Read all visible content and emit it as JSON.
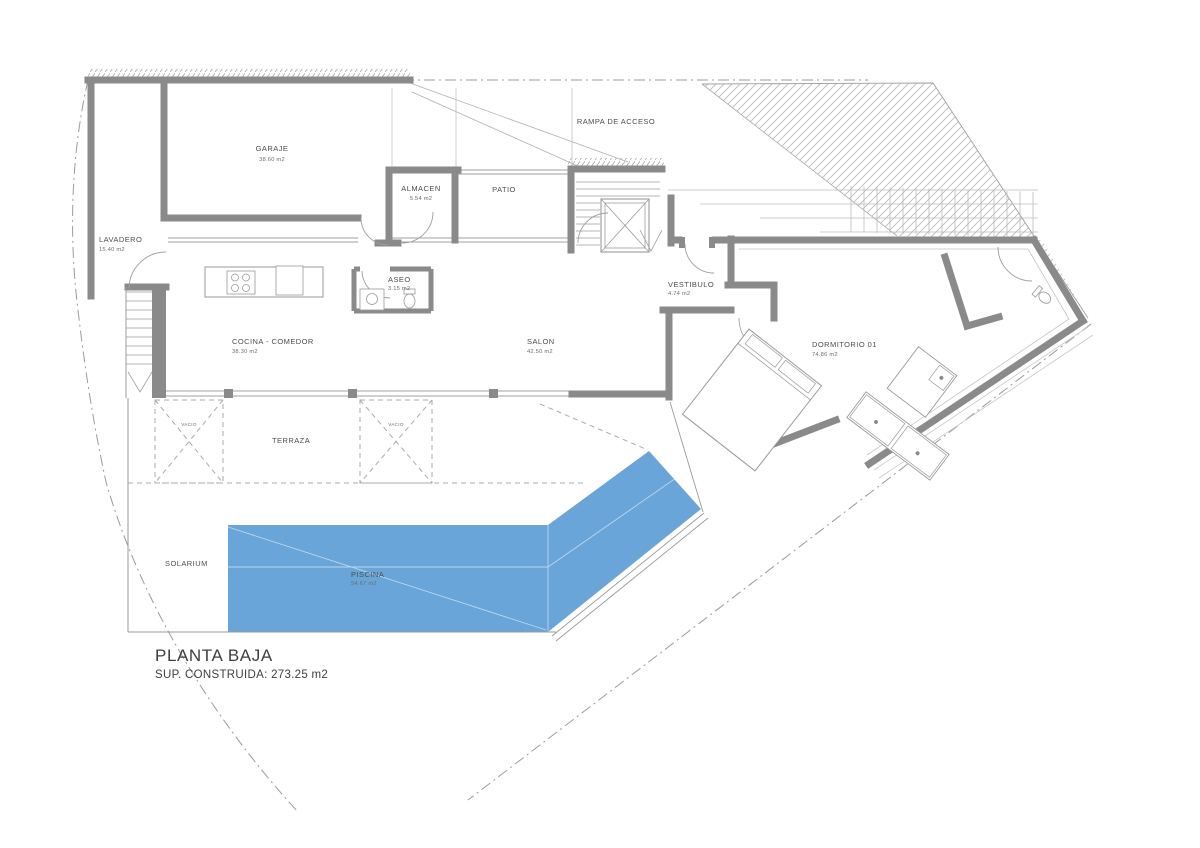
{
  "drawing": {
    "title": "PLANTA BAJA",
    "subtitle": "SUP. CONSTRUIDA: 273.25 m2",
    "colors": {
      "pool_blue": "#6aa5d9",
      "wall_gray": "#8a8a8a",
      "line_gray": "#9e9e9e",
      "text_gray": "#4d4d4d"
    },
    "rooms": {
      "garaje": {
        "label": "GARAJE",
        "area": "38.60 m2"
      },
      "lavadero": {
        "label": "LAVADERO",
        "area": "15.40 m2"
      },
      "almacen": {
        "label": "ALMACEN",
        "area": "5.54 m2"
      },
      "patio": {
        "label": "PATIO"
      },
      "rampa": {
        "label": "RAMPA DE ACCESO"
      },
      "aseo": {
        "label": "ASEO",
        "area": "3.15 m2"
      },
      "cocina": {
        "label": "COCINA - COMEDOR",
        "area": "38.30 m2"
      },
      "salon": {
        "label": "SALON",
        "area": "42.50 m2"
      },
      "vestibulo": {
        "label": "VESTIBULO",
        "area": "4.74 m2"
      },
      "dormitorio": {
        "label": "DORMITORIO 01",
        "area": "74.86 m2"
      },
      "terraza": {
        "label": "TERRAZA"
      },
      "vacio": {
        "label": "VACIO"
      },
      "solarium": {
        "label": "SOLARIUM"
      },
      "piscina": {
        "label": "PISCINA",
        "area": "54.67 m2"
      }
    }
  }
}
